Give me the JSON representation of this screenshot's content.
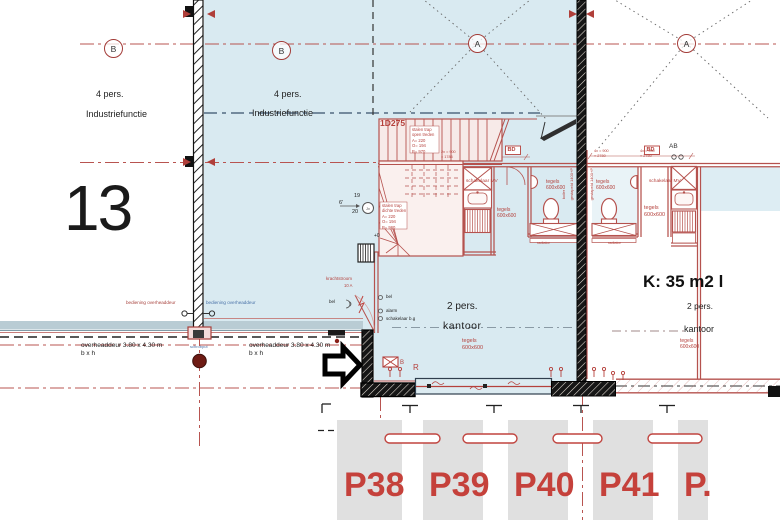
{
  "colors": {
    "floor_blue": "#d9eaf1",
    "drawing_red": "#b5524e",
    "parking_label_red": "#c5413b",
    "pavement_band": "#b9ccd4",
    "stall_gray": "#e0e0e0",
    "wall_black": "#1a1a1a"
  },
  "grid": {
    "a": "A",
    "b": "B"
  },
  "unit": {
    "number": "13",
    "persons": "4 pers.",
    "function": "Industriefunctie"
  },
  "hall": {
    "persons": "4 pers.",
    "function": "Industriefunctie"
  },
  "stair": {
    "id": "1D275",
    "spec_upper": "stalen trap\nopen treden\nA= 220\nO= 194\nB= 970",
    "spec_lower": "stalen trap\ndichte treden\nA= 220\nO= 194\nB= 960",
    "note_6": "6'",
    "note_19": "19",
    "note_20": "20",
    "note_jv": "Jv",
    "level_mark": "+0"
  },
  "electrical": {
    "krachtstroom": "krachtstroom",
    "amps": "10 A",
    "bel": "bel",
    "alarm": "alarm",
    "schakelaar_bg": "schakelaar b.g",
    "schakelaar_mv": "schakelaar MV"
  },
  "rooms": {
    "persons": "2 pers.",
    "kantoor": "kantoor",
    "area_label": "K: 35 m2 l",
    "tiles": "tegels\n600x600",
    "radiator": "radiator",
    "ab": "AB",
    "bd": "BD",
    "stacked": "gestapeld 1400+P",
    "boiler": "boiler"
  },
  "dims": {
    "d1": "2x = 900\n= 1786",
    "d2": "4x = 900\n= 2780"
  },
  "doors": {
    "bediening": "bediening overheaddeur",
    "overheaddeur_dim": "overheaddeur 3.80 x 4.30 m\nb x h",
    "schrobput": "schrobput",
    "r_label": "R",
    "b_label": "B"
  },
  "parking": {
    "spaces": [
      "P38",
      "P39",
      "P40",
      "P41",
      "P."
    ]
  }
}
